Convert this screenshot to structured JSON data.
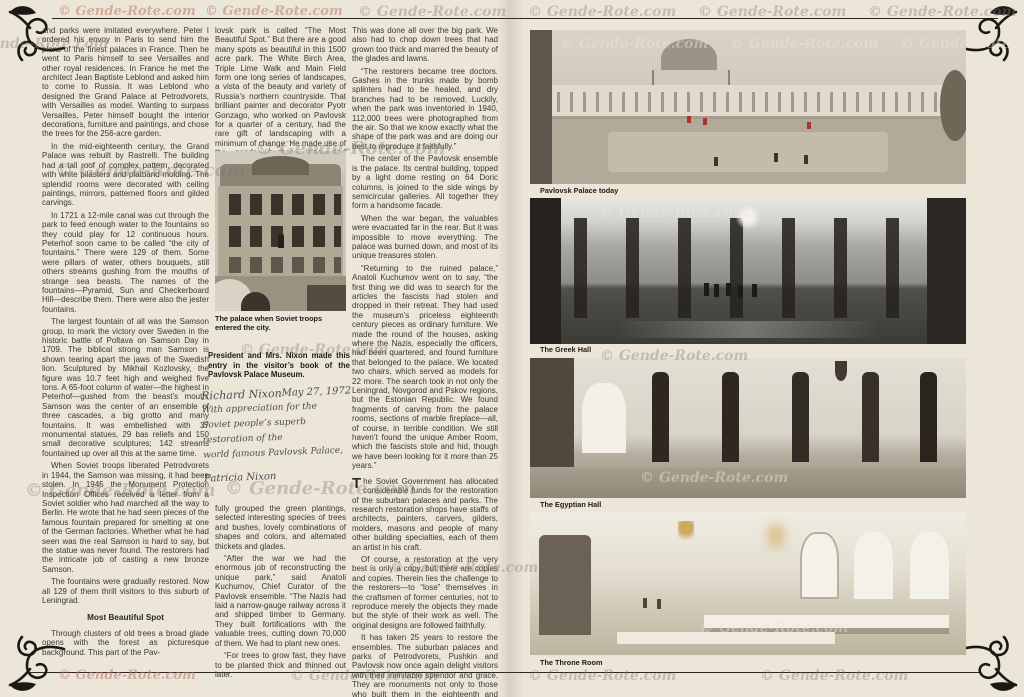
{
  "watermark": {
    "text": "© Gende-Rote.com"
  },
  "article": {
    "col1": {
      "p1": "and parks were imitated everywhere. Peter I ordered his envoy in Paris to send him the plans of the finest palaces in France. Then he went to Paris himself to see Versailles and other royal residences. In France he met the architect Jean Baptiste Leblond and asked him to come to Russia. It was Leblond who designed the Grand Palace at Petrodvorets, with Versailles as model. Wanting to surpass Versailles, Peter himself bought the interior decorations, furniture and paintings, and chose the trees for the 256-acre garden.",
      "p2": "In the mid-eighteenth century, the Grand Palace was rebuilt by Rastrelli. The building had a tall roof of complex pattern, decorated with white pilasters and platband molding. The splendid rooms were decorated with ceiling paintings, mirrors, patterned floors and gilded carvings.",
      "p3": "In 1721 a 12-mile canal was cut through the park to feed enough water to the fountains so they could play for 12 continuous hours. Peterhof soon came to be called “the city of fountains.” There were 129 of them. Some were pillars of water, others bouquets, still others streams gushing from the mouths of strange sea beasts. The names of the fountains—Pyramid, Sun and Checkerboard Hill—describe them. There were also the jester fountains.",
      "p4": "The largest fountain of all was the Samson group, to mark the victory over Sweden in the historic battle of Poltava on Samson Day in 1709. The biblical strong man Samson is shown tearing apart the jaws of the Swedish lion. Sculptured by Mikhail Kozlovsky, the figure was 10.7 feet high and weighed five tons. A 65-foot column of water—the highest in Peterhof—gushed from the beast’s mouth. Samson was the center of an ensemble of three cascades, a big grotto and many fountains. It was embellished with 37 monumental statues, 29 bas reliefs and 150 small decorative sculptures; 142 streams fountained up over all this at the same time.",
      "p5": "When Soviet troops liberated Petrodvorets in 1944, the Samson was missing, it had been stolen. In 1945 the Monument Protection Inspection Offices received a letter from a Soviet soldier who had marched all the way to Berlin. He wrote that he had seen pieces of the famous fountain prepared for smelting at one of the German factories. Whether what he had seen was the real Samson is hard to say, but the statue was never found. The restorers had the intricate job of casting a new bronze Samson.",
      "p6": "The fountains were gradually restored. Now all 129 of them thrill visitors to this suburb of Leningrad.",
      "heading": "Most Beautiful Spot",
      "p7": "Through clusters of old trees a broad glade opens with the forest as picturesque background. This part of the Pav-"
    },
    "col2": {
      "p1": "lovsk park is called “The Most Beautiful Spot.” But there are a good many spots as beautiful in this 1500 acre park. The White Birch Area, Triple Lime Walk and Main Field form one long series of landscapes, a vista of the beauty and variety of Russia’s northern countryside. That brilliant painter and decorator Pyotr Gonzago, who worked on Pavlovsk for a quarter of a century, had the rare gift of landscaping with a minimum of change. He made use of the ponds, bushes, isles, and winding paths, skill-",
      "photo_caption": "The palace when Soviet troops entered the city.",
      "credit": "President and Mrs. Nixon made this entry in the visitor’s book of the Pavlovsk Palace Museum.",
      "p2": "fully grouped the green plantings, selected interesting species of trees and bushes, lovely combinations of shapes and colors, and alternated thickets and glades.",
      "p3": "“After the war we had the enormous job of reconstructing the unique park,” said Anatoli Kuchumov, Chief Curator of the Pavlovsk ensemble. “The Nazis had laid a narrow-gauge railway across it and shipped timber to Germany. They built fortifications with the valuable trees, cutting down 70,000 of them. We had to plant new ones.",
      "p4": "“For trees to grow fast, they have to be planted thick and thinned out later."
    },
    "col3": {
      "p1": "This was done all over the big park. We also had to chop down trees that had grown too thick and marred the beauty of the glades and lawns.",
      "p2": "“The restorers became tree doctors. Gashes in the trunks made by bomb splinters had to be healed, and dry branches had to be removed. Luckily, when the park was inventoried in 1940, 112,000 trees were photographed from the air. So that we know exactly what the shape of the park was and are doing our best to reproduce it faithfully.”",
      "p3": "The center of the Pavlovsk ensemble is the palace. Its central building, topped by a light dome resting on 64 Doric columns, is joined to the side wings by semicircular galleries. All together they form a handsome facade.",
      "p4": "When the war began, the valuables were evacuated far in the rear. But it was impossible to move everything. The palace was burned down, and most of its unique treasures stolen.",
      "p5": "“Returning to the ruined palace,” Anatoli Kuchumov went on to say, “the first thing we did was to search for the articles the fascists had stolen and dropped in their retreat. They had used the museum’s priceless eighteenth century pieces as ordinary furniture. We made the round of the houses, asking where the Nazis, especially the officers, had been quartered, and found furniture that belonged to the palace. We located two chairs, which served as models for 22 more. The search took in not only the Leningrad, Novgorod and Pskov regions, but the Estonian Republic. We found fragments of carving from the palace rooms, sections of marble fireplace—all, of course, in terrible condition. We still haven’t found the unique Amber Room, which the fascists stole and hid, though we have been looking for it more than 25 years.”",
      "dropcap": "T",
      "p6": "he Soviet Government has allocated considerable funds for the restoration of the suburban palaces and parks. The research restoration shops have staffs of architects, painters, carvers, gilders, molders, masons and people of many other building specialties, each of them an artist in his craft.",
      "p7": "Of course, a restoration at the very best is only a copy, but there are copies and copies. Therein lies the challenge to the restorers—to “lose” themselves in the craftsmen of former centuries, not to reproduce merely the objects they made but the style of their work as well. The original designs are followed faithfully.",
      "p8": "It has taken 25 years to restore the ensembles. The suburban palaces and parks of Petrodvorets, Pushkin and Pavlovsk now once again delight visitors with their inimitable splendor and grace. They are monuments not only to those who built them in the eighteenth and nineteenth centuries, but also to the Leningraders who re-created this beauty out of ruins and ashes."
    },
    "handwriting": {
      "sig": "Richard Nixon",
      "date": "May 27, 1972",
      "l2": "With appreciation for the",
      "l3": "Soviet people’s superb",
      "l4": "restoration of the",
      "l5": "world famous Pavlovsk Palace,",
      "l6": "Patricia Nixon"
    }
  },
  "photos": {
    "cap1": "Pavlovsk Palace today",
    "cap2": "The Greek Hall",
    "cap3": "The Egyptian Hall",
    "cap4": "The Throne Room"
  }
}
